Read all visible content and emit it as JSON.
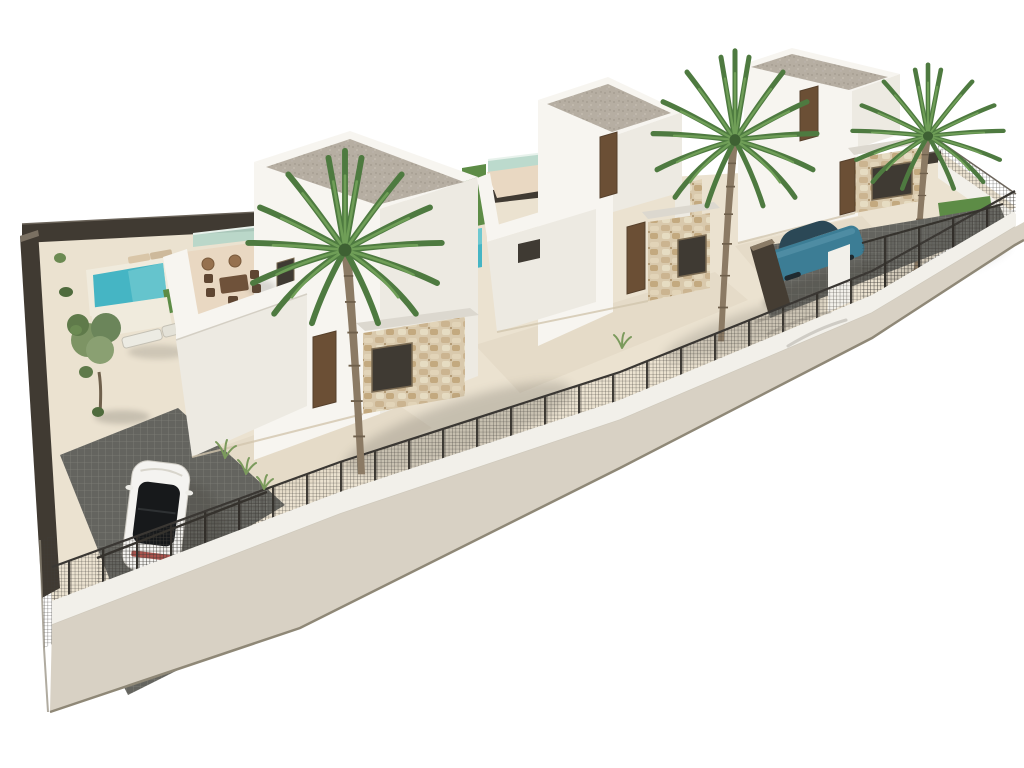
{
  "scene": {
    "type": "3d-architectural-rendering",
    "description": "Aerial 3D render of three modern white villas on an elongated diagonal plot with flat gravel roofs, stone-clad entrance volumes, roof terraces, turquoise pools, palm trees, a white car on a dark paved driveway, a blue car behind a gate wall, dark mesh perimeter fencing on a low white wall and a sidewalk, all on a pure white background.",
    "objects": [
      "villa-1-front",
      "villa-2-middle",
      "villa-3-right",
      "pool-1",
      "pool-2",
      "pool-3",
      "palm-tree-large",
      "palm-tree-middle",
      "palm-tree-right",
      "olive-tree",
      "shrub-row",
      "grass-tufts",
      "white-car",
      "blue-car",
      "roof-terrace-dining-set",
      "sun-loungers",
      "perimeter-mesh-fence",
      "driveway-gate",
      "boundary-wall-left",
      "low-white-wall",
      "sidewalk",
      "paved-driveway"
    ],
    "palette": {
      "background": "#ffffff",
      "sand": "#ebe2d0",
      "apron": "#e5dbc8",
      "deck": "#f0ebdd",
      "terrace": "#e9d8c2",
      "sidewalk": "#d8d1c4",
      "curb_wall": "#f2f0ea",
      "wall_bright": "#f7f5f0",
      "wall_shade": "#edeae2",
      "gravel": "#b6aea2",
      "stone": "#d9c9ac",
      "mesh": "#3f3c37",
      "dark_wall": "#453d33",
      "boundary_wall": "#403a32",
      "pool": "#45b5c4",
      "pool_light": "#7fd0d6",
      "lawn": "#5d8c46",
      "palm_dark": "#4e7a40",
      "palm_light": "#6f9e57",
      "trunk": "#8b7a64",
      "door": "#6b4f35",
      "window_dark": "#3f3a33",
      "window_frame": "#7a6a52",
      "car_white": "#f4f3f0",
      "car_glass": "#17191b",
      "car_red": "#a2403a",
      "car_blue": "#3c7d95",
      "car_blue_dark": "#2b4856",
      "glass": "#b5d6c8",
      "shadow": "#4a463f",
      "paver": "#64645f",
      "paver_joint": "#7f7f78",
      "edge_line": "#8f8877"
    }
  }
}
